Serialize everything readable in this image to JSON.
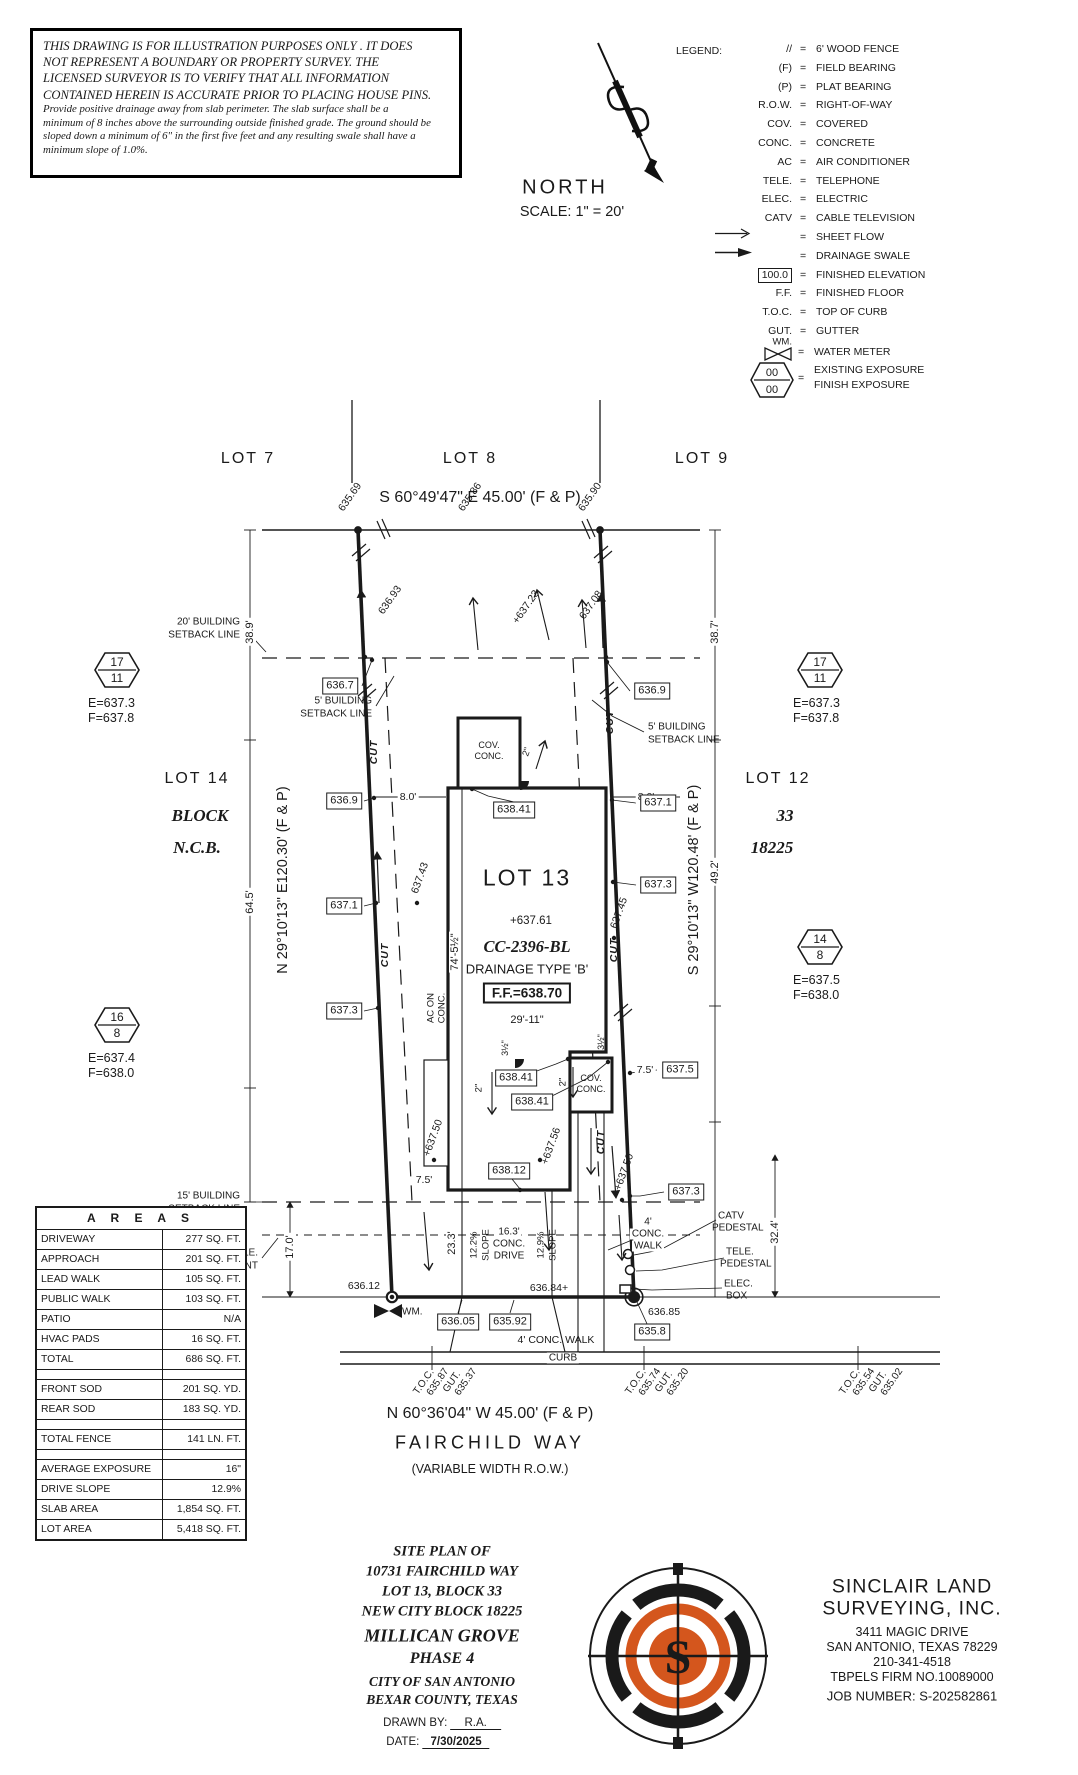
{
  "colors": {
    "accent": "#d4561d",
    "ink": "#1a1a1a"
  },
  "disclaimer": {
    "l1": "THIS DRAWING IS FOR ILLUSTRATION PURPOSES ONLY . IT DOES",
    "l2": "NOT REPRESENT A BOUNDARY OR PROPERTY SURVEY. THE",
    "l3": "LICENSED SURVEYOR IS TO VERIFY THAT ALL INFORMATION",
    "l4": "CONTAINED HEREIN IS ACCURATE PRIOR TO PLACING HOUSE PINS.",
    "n1": "Provide positive drainage away from slab perimeter. The slab surface shall be a",
    "n2": "minimum of 8 inches above the surrounding outside finished grade. The ground should be",
    "n3": "sloped down a minimum of 6\" in the first five feet and any resulting swale shall have a",
    "n4": "minimum slope of 1.0%."
  },
  "north": {
    "label": "NORTH",
    "scale": "SCALE: 1\" = 20'"
  },
  "legend": {
    "title": "LEGEND:",
    "eq": "=",
    "items": [
      {
        "sym": "//",
        "desc": "6' WOOD FENCE"
      },
      {
        "sym": "(F)",
        "desc": "FIELD BEARING"
      },
      {
        "sym": "(P)",
        "desc": "PLAT BEARING"
      },
      {
        "sym": "R.O.W.",
        "desc": "RIGHT-OF-WAY"
      },
      {
        "sym": "COV.",
        "desc": "COVERED"
      },
      {
        "sym": "CONC.",
        "desc": "CONCRETE"
      },
      {
        "sym": "AC",
        "desc": "AIR CONDITIONER"
      },
      {
        "sym": "TELE.",
        "desc": "TELEPHONE"
      },
      {
        "sym": "ELEC.",
        "desc": "ELECTRIC"
      },
      {
        "sym": "CATV",
        "desc": "CABLE TELEVISION"
      },
      {
        "icon": "sheet-flow",
        "desc": "SHEET FLOW"
      },
      {
        "icon": "drainage-swale",
        "desc": "DRAINAGE SWALE"
      },
      {
        "sym": "100.0",
        "boxed": true,
        "desc": "FINISHED ELEVATION"
      },
      {
        "sym": "F.F.",
        "desc": "FINISHED FLOOR"
      },
      {
        "sym": "T.O.C.",
        "desc": "TOP OF CURB"
      },
      {
        "sym": "GUT.",
        "desc": "GUTTER"
      }
    ],
    "wm_label": "WM.",
    "wm_desc": "WATER METER",
    "exposure": {
      "v1": "00",
      "v2": "00",
      "d1": "EXISTING EXPOSURE",
      "d2": "FINISH EXPOSURE"
    }
  },
  "lots": {
    "lot7": "LOT 7",
    "lot8": "LOT 8",
    "lot9": "LOT 9",
    "lot14": "LOT 14",
    "lot12": "LOT 12",
    "block_left": "BLOCK",
    "ncb_left": "N.C.B.",
    "block_right": "33",
    "ncb_right": "18225"
  },
  "bearings": {
    "top": "S 60°49'47\" E 45.00' (F & P)",
    "bottom": "N 60°36'04\" W 45.00' (F & P)",
    "left": "N 29°10'13\" E120.30' (F & P)",
    "right": "S 29°10'13\" W120.48' (F & P)"
  },
  "street": {
    "name": "FAIRCHILD WAY",
    "row": "(VARIABLE WIDTH R.O.W.)"
  },
  "markers": [
    {
      "top": "17",
      "bottom": "11",
      "e": "E=637.3",
      "f": "F=637.8"
    },
    {
      "top": "17",
      "bottom": "11",
      "e": "E=637.3",
      "f": "F=637.8"
    },
    {
      "top": "14",
      "bottom": "8",
      "e": "E=637.5",
      "f": "F=638.0"
    },
    {
      "top": "16",
      "bottom": "8",
      "e": "E=637.4",
      "f": "F=638.0"
    }
  ],
  "setbacks": {
    "s20a": "20' BUILDING",
    "s20b": "SETBACK LINE",
    "s5a": "5' BUILDING",
    "s5b": "SETBACK LINE",
    "s15a": "15' BUILDING",
    "s15b": "SETBACK LINE",
    "ea": "10' ELEC., GAS, TELE.",
    "eb": "& CATV EASEMENT"
  },
  "house": {
    "lot": "LOT 13",
    "spot": "+637.61",
    "cc": "CC-2396-BL",
    "drain": "DRAINAGE TYPE 'B'",
    "ff": "F.F.=638.70",
    "w": "29'-11\"",
    "len": "74'-5½\"",
    "cov": "COV.",
    "conc": "CONC.",
    "ac1": "AC ON",
    "ac2": "CONC."
  },
  "dims": {
    "d389": "38.9'",
    "d387": "38.7'",
    "d645": "64.5'",
    "d492": "49.2'",
    "d170": "17.0'",
    "d324": "32.4'",
    "d233": "23.3'",
    "d80": "8.0'",
    "d75": "7.5'",
    "s122": "12.2%",
    "s129": "12.9%",
    "slope": "SLOPE",
    "dr1": "16.3'",
    "dr2": "CONC.",
    "dr3": "DRIVE",
    "wk1": "4'",
    "wk2": "CONC.",
    "wk3": "WALK",
    "wkb": "4' CONC. WALK",
    "i2": "2\"",
    "i35": "3½\""
  },
  "boxes": {
    "e6367": "636.7",
    "e6369": "636.9",
    "e6371": "637.1",
    "e6373": "637.3",
    "e6375": "637.5",
    "e63841": "638.41",
    "e63812": "638.12",
    "e63605": "636.05",
    "e63592": "635.92",
    "e6358": "635.8"
  },
  "spots": {
    "a": "635.69",
    "b": "635.86",
    "c": "635.90",
    "d": "636.93",
    "e": "+637.23",
    "f": "637.08",
    "g": "637.43",
    "h": "637.45",
    "i": "+637.50",
    "j": "+637.56",
    "k": "636.12",
    "l": "636.84+",
    "m": "636.85"
  },
  "cut": "CUT",
  "misc": {
    "wm": "WM.",
    "curb": "CURB",
    "catv1": "CATV",
    "catv2": "PEDESTAL",
    "tele1": "TELE.",
    "tele2": "PEDESTAL",
    "elec1": "ELEC.",
    "elec2": "BOX"
  },
  "toc": {
    "t": "T.O.C.",
    "g": "GUT.",
    "c1v1": "635.87",
    "c1v2": "635.37",
    "c2v1": "635.74",
    "c2v2": "635.20",
    "c3v1": "635.54",
    "c3v2": "635.02"
  },
  "areas": {
    "title": "A R E A S",
    "rows": [
      {
        "l": "DRIVEWAY",
        "v": "277 SQ. FT."
      },
      {
        "l": "APPROACH",
        "v": "201 SQ. FT."
      },
      {
        "l": "LEAD WALK",
        "v": "105 SQ. FT."
      },
      {
        "l": "PUBLIC WALK",
        "v": "103 SQ. FT."
      },
      {
        "l": "PATIO",
        "v": "N/A"
      },
      {
        "l": "HVAC PADS",
        "v": "16 SQ. FT."
      },
      {
        "l": "TOTAL",
        "v": "686 SQ. FT."
      },
      {
        "gap": true
      },
      {
        "l": "FRONT SOD",
        "v": "201 SQ. YD."
      },
      {
        "l": "REAR SOD",
        "v": "183 SQ. YD."
      },
      {
        "gap": true
      },
      {
        "l": "TOTAL FENCE",
        "v": "141 LN. FT."
      },
      {
        "gap": true
      },
      {
        "l": "AVERAGE EXPOSURE",
        "v": "16\""
      },
      {
        "l": "DRIVE SLOPE",
        "v": "12.9%"
      },
      {
        "l": "SLAB AREA",
        "v": "1,854 SQ. FT."
      },
      {
        "l": "LOT AREA",
        "v": "5,418 SQ. FT."
      }
    ]
  },
  "titleblock": {
    "l1": "SITE PLAN OF",
    "l2": "10731 FAIRCHILD WAY",
    "l3": "LOT 13, BLOCK 33",
    "l4": "NEW CITY BLOCK 18225",
    "l5": "MILLICAN GROVE",
    "l6": "PHASE 4",
    "l7": "CITY OF SAN ANTONIO",
    "l8": "BEXAR COUNTY, TEXAS",
    "drawn_label": "DRAWN BY:",
    "drawn": "R.A.",
    "date_label": "DATE:",
    "date": "7/30/2025"
  },
  "firm": {
    "n1": "SINCLAIR LAND",
    "n2": "SURVEYING, INC.",
    "a1": "3411 MAGIC DRIVE",
    "a2": "SAN ANTONIO, TEXAS 78229",
    "a3": "210-341-4518",
    "a4": "TBPELS FIRM NO.10089000",
    "job": "JOB NUMBER: S-202582861",
    "monogram": "S"
  }
}
